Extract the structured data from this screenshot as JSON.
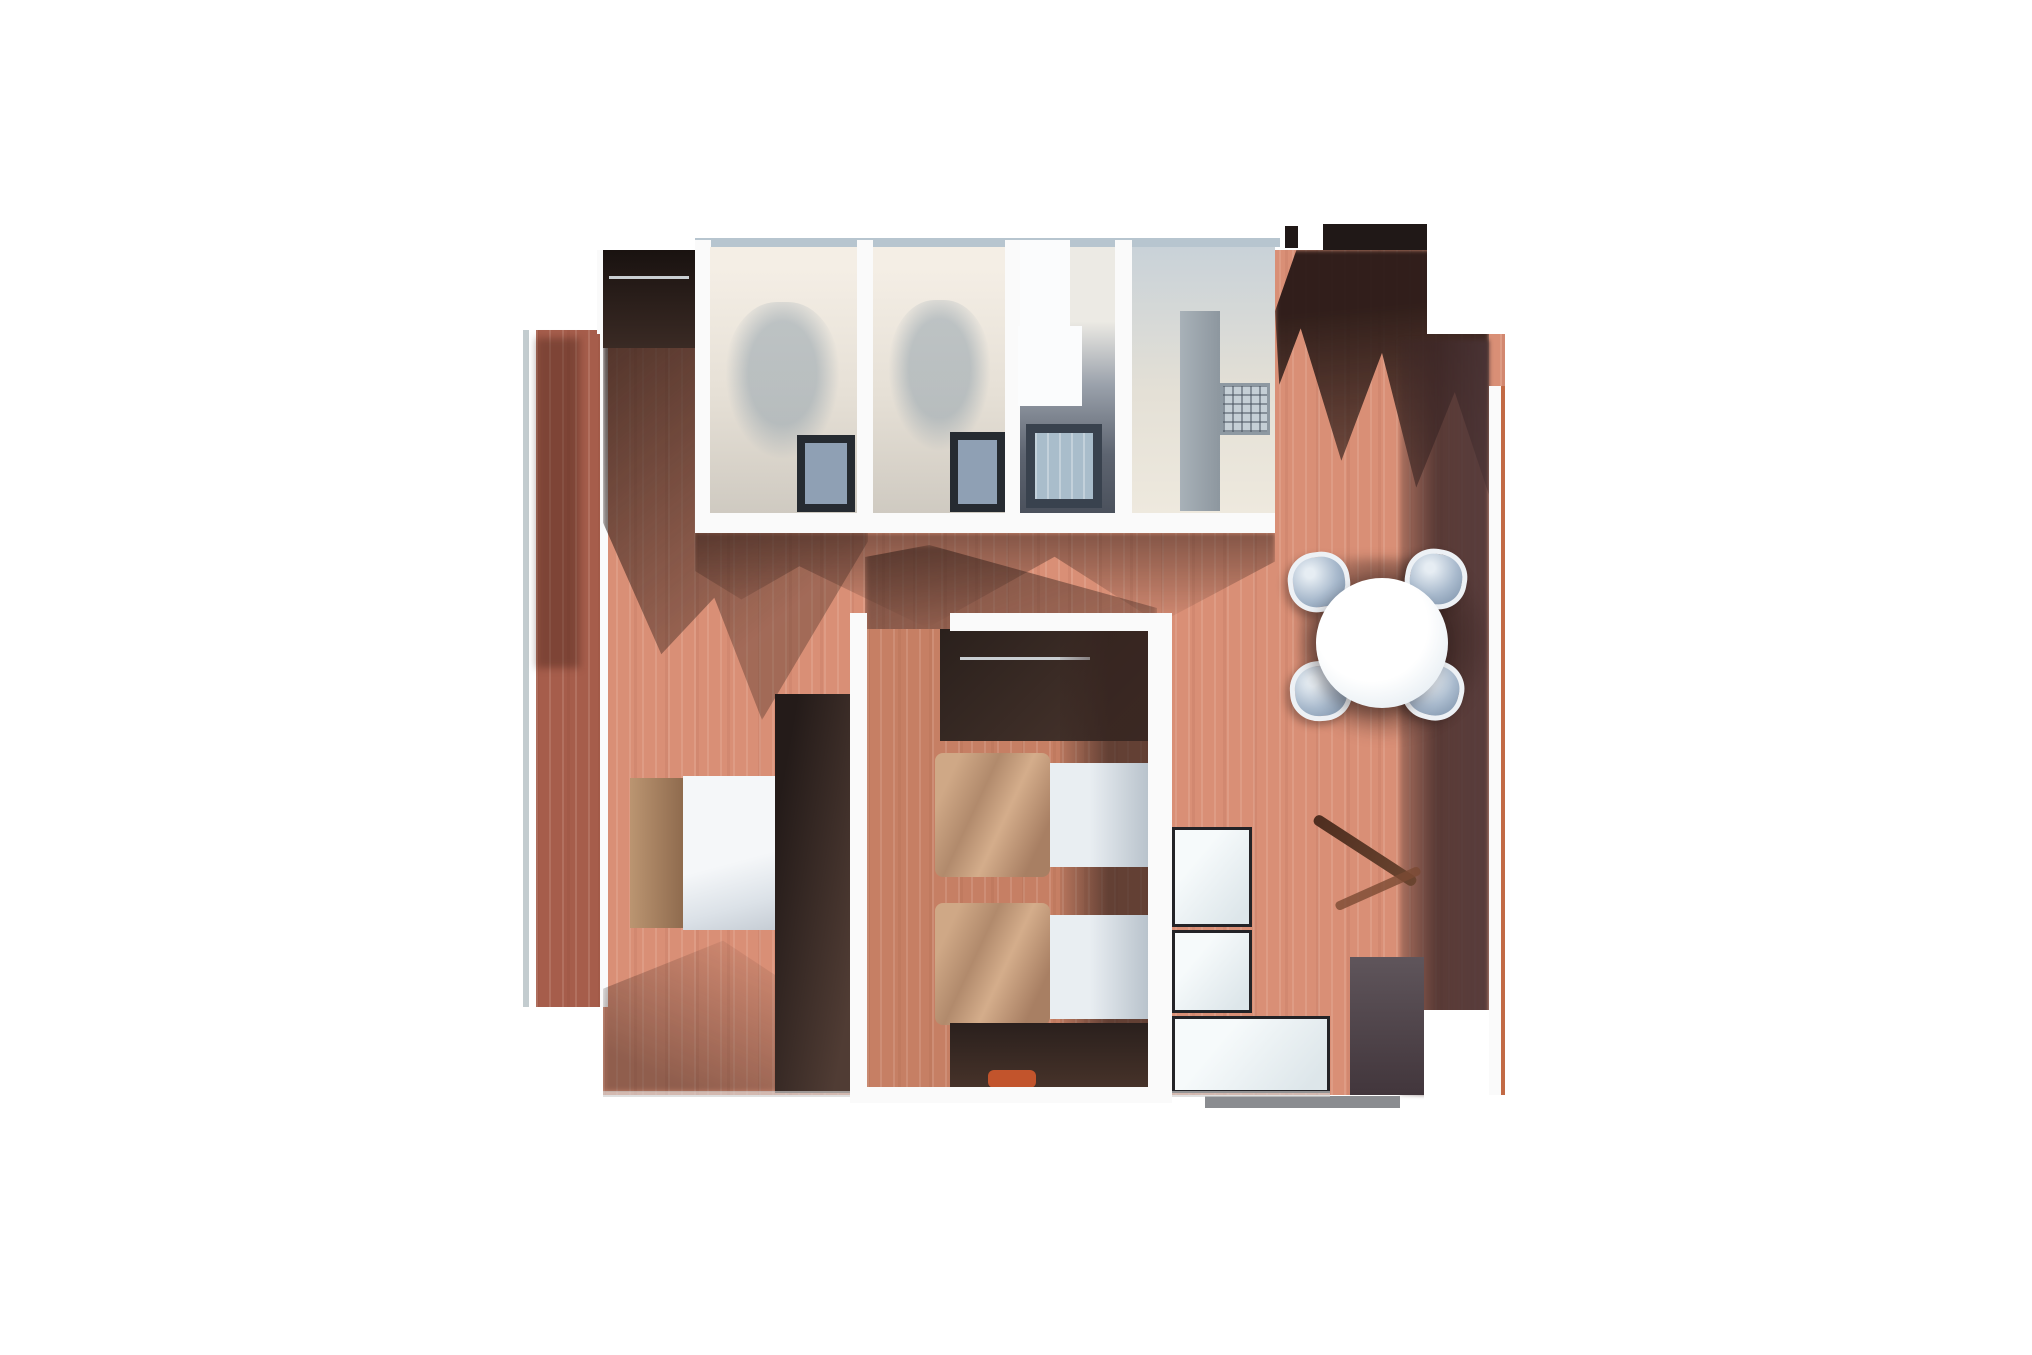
{
  "scene": {
    "description": "Top-down 3D rendered floor plan of a two-bedroom apartment, photoreal style, on a plain white background",
    "no_visible_text": true
  },
  "palette": {
    "background": "#ffffff",
    "floor_main": "#d98f76",
    "floor_mid": "#c67f64",
    "balcony_floor": "#a65d4b",
    "railing": "#c3cccf",
    "wall_white": "#fafafa",
    "window_band": "#b7c5cf",
    "top_wall_dark": "#201817",
    "fixture_white": "#fbfcfd",
    "step_grey": "#8a8c90",
    "edge_grey": "#cfcfcf",
    "accent_orange": "#c2542c",
    "accent_edge": "#c26a45",
    "shadow_brown": "#4a332d",
    "wardrobe_dark": "#241b19",
    "blanket_tan": "#c49e7e",
    "duvet_white": "#eff2f5",
    "bed_wood": "#b08a66",
    "chair_grey_blue": "#a9bacd",
    "table_white": "#f6fafd",
    "cabinet_white": "#eef3f5",
    "kitchen_cabinet_grey": "#9aa3ab",
    "bath_floor_dark": "#5d6470",
    "window_glass": "#9db3c2",
    "room_cream": "#efe8dd",
    "sideboard_dark": "#53424a"
  },
  "rooms": [
    {
      "id": "balcony",
      "name": "balcony with railing"
    },
    {
      "id": "bedroom-left",
      "name": "master bedroom with double bed and wardrobes"
    },
    {
      "id": "bathroom-1",
      "name": "small room / bathroom top-left"
    },
    {
      "id": "bathroom-2",
      "name": "small room / bathroom top-middle"
    },
    {
      "id": "wc",
      "name": "toilet-shower room with white fixtures"
    },
    {
      "id": "kitchen",
      "name": "kitchen with grey cabinet and radiator grille"
    },
    {
      "id": "bedroom-middle",
      "name": "second bedroom with two single beds"
    },
    {
      "id": "living-dining",
      "name": "living-dining room with round table"
    }
  ],
  "furniture": {
    "double_bed_count": 1,
    "single_bed_count": 2,
    "dining_chair_count": 4,
    "dining_table_count": 1,
    "wardrobe_count": 4,
    "white_storage_unit_count": 3,
    "window_mat_count": 3,
    "radiator_count": 1,
    "dark_sideboard_count": 1,
    "orange_object_count": 1
  }
}
